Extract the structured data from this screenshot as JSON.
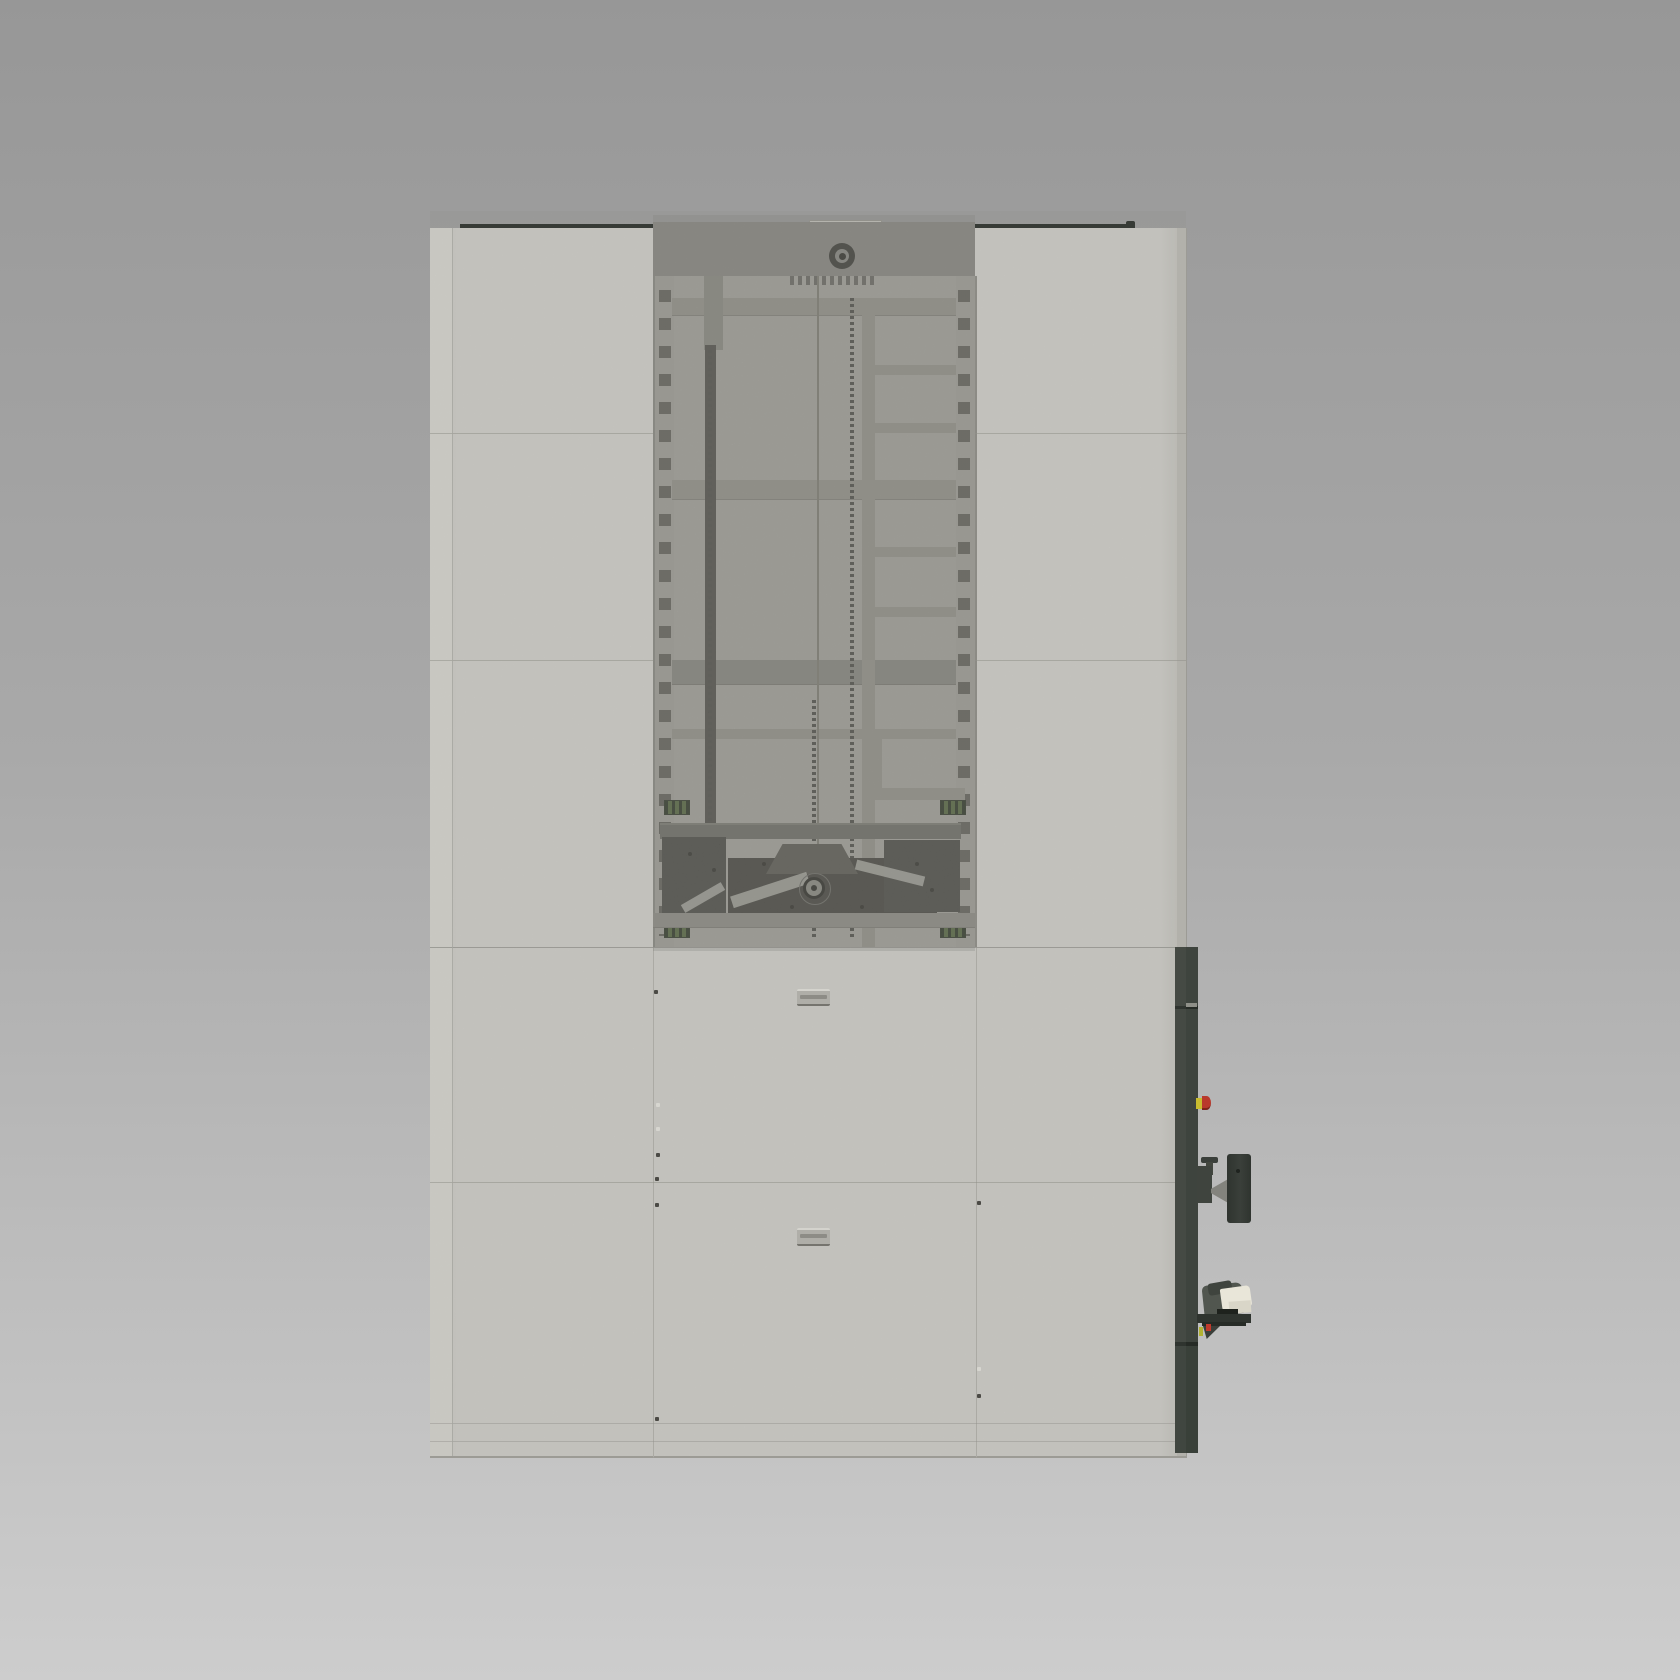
{
  "scene": {
    "description": "3D CAD-style render of an industrial vertical storage lift machine, front view, on neutral gradient backdrop",
    "background": {
      "top": "#979797",
      "mid": "#a9a9a9",
      "bottom": "#cdcdcd"
    }
  },
  "machine": {
    "parts": [
      "storage-cabinet-body",
      "top-drive-header-with-hub",
      "open-mast-section-with-perforated-rails",
      "cross-beams-and-ladder-rungs",
      "lift-pillar-with-drive-chains",
      "extractor-carriage-with-pulley",
      "green-sensor-blocks",
      "recessed-panel-handle-upper",
      "recessed-panel-handle-lower",
      "side-electrical-strip",
      "emergency-stop-button",
      "monitor-vesa-bracket",
      "barcode-scanner-on-shelf"
    ],
    "palette": {
      "bg_top": "#979797",
      "bg_mid": "#a9a9a9",
      "bg_bottom": "#cdcdcd",
      "panel": "#cac9c4",
      "panel_edge_light": "#d1d0ca",
      "panel_edge_dark": "#b8b7b1",
      "panel_border": "#9c9b95",
      "seam_strong": "#94938d",
      "top_rail": "#2f332e",
      "header": "#8c8b85",
      "interior_back": "#a9a8a2",
      "rail": "#a5a49e",
      "slot": "#57564f",
      "beam": "#98978f",
      "beam_dark": "#8b8a83",
      "pillar": "#504f4a",
      "pillar_top": "#8e8d86",
      "chain": "#4e4d48",
      "cable": "#807f76",
      "carriage_dark": "#45443f",
      "carriage_mid": "#5b5a53",
      "carriage_block": "#4a4a45",
      "brace": "#b2b1aa",
      "pulley_ring": "#2b2b27",
      "sensor_green": "#55683f",
      "sensor_stripe": "#2c3424",
      "side_strip": "#3e443e",
      "side_strip_dark": "#262b26",
      "estop_red": "#b9392c",
      "estop_yellow": "#c9bc2f",
      "bracket": "#3a3f3a",
      "bracket_light": "#83837d",
      "scanner_dark": "#51564f",
      "scanner_cream": "#e9e6d9",
      "scanner_slot": "#1e221d",
      "handle_face": "#b5b4ae",
      "handle_light": "#deddd7",
      "handle_shadow": "#74736d",
      "screw_dark": "#45443f",
      "screw_light": "#e2e1db",
      "bolt": "#2a2a26"
    }
  }
}
